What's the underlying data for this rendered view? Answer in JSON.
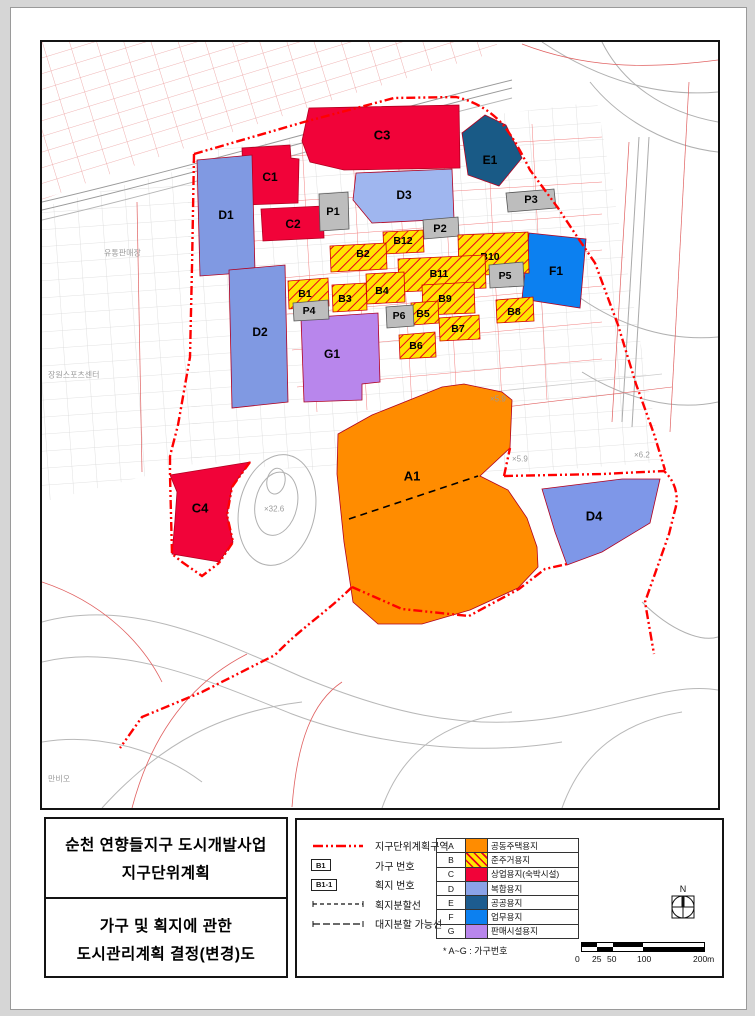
{
  "page": {
    "title_block": {
      "line1": "순천 연향들지구 도시개발사업",
      "line2": "지구단위계획",
      "line3": "가구 및 획지에 관한",
      "line4": "도시관리계획 결정(변경)도"
    },
    "legend": {
      "line_items": [
        {
          "label": "지구단위계획구역"
        },
        {
          "label": "가구 번호",
          "chip": "B1"
        },
        {
          "label": "획지 번호",
          "chip": "B1-1"
        },
        {
          "label": "획지분할선"
        },
        {
          "label": "대지분할 가능선"
        }
      ],
      "use_table": [
        {
          "code": "A",
          "use": "공동주택용지",
          "color": "#ff8c00",
          "hatch": false
        },
        {
          "code": "B",
          "use": "준주거용지",
          "color": "#ffe500",
          "hatch": true
        },
        {
          "code": "C",
          "use": "상업용지(숙박시설)",
          "color": "#f10339",
          "hatch": false
        },
        {
          "code": "D",
          "use": "복합용지",
          "color": "#8ba3e8",
          "hatch": false
        },
        {
          "code": "E",
          "use": "공공용지",
          "color": "#1d5c8f",
          "hatch": false
        },
        {
          "code": "F",
          "use": "업무용지",
          "color": "#0c80f0",
          "hatch": false
        },
        {
          "code": "G",
          "use": "판매시설용지",
          "color": "#b886ec",
          "hatch": false
        }
      ],
      "footnote": "* A~G : 가구번호"
    },
    "north_label": "N",
    "scale_bar": {
      "labels": [
        "0",
        "25",
        "50",
        "100",
        "200m"
      ]
    },
    "map": {
      "zones": [
        {
          "id": "C3",
          "label": "C3",
          "color": "#f10339",
          "points": "260,99 267,66 417,63 418,126 302,128 268,120",
          "lx": 340,
          "ly": 93,
          "fs": 13
        },
        {
          "id": "E1",
          "label": "E1",
          "color": "#195a86",
          "points": "420,91 443,73 464,83 480,116 457,144 426,133",
          "lx": 448,
          "ly": 118,
          "fs": 12
        },
        {
          "id": "C1",
          "label": "C1",
          "color": "#f10339",
          "points": "200,106 248,103 249,116 257,117 256,161 202,163",
          "lx": 228,
          "ly": 135,
          "fs": 12
        },
        {
          "id": "C2",
          "label": "C2",
          "color": "#f10339",
          "points": "219,167 281,164 282,196 221,199",
          "lx": 251,
          "ly": 182,
          "fs": 12
        },
        {
          "id": "D1",
          "label": "D1",
          "color": "#8099e2",
          "points": "155,118 210,113 213,230 158,234",
          "lx": 184,
          "ly": 173,
          "fs": 12
        },
        {
          "id": "D2",
          "label": "D2",
          "color": "#8099e2",
          "points": "187,228 243,223 246,360 190,366",
          "lx": 218,
          "ly": 290,
          "fs": 12
        },
        {
          "id": "D3",
          "label": "D3",
          "color": "#9fb6ef",
          "points": "314,131 410,127 412,177 330,181 311,158",
          "lx": 362,
          "ly": 153,
          "fs": 12
        },
        {
          "id": "P1",
          "label": "P1",
          "color": "#bdbdbd",
          "stroke": "#555",
          "points": "277,152 306,150 307,187 278,189",
          "lx": 291,
          "ly": 170,
          "fs": 11
        },
        {
          "id": "P2",
          "label": "P2",
          "color": "#bdbdbd",
          "stroke": "#555",
          "points": "381,178 416,175 417,194 382,197",
          "lx": 398,
          "ly": 187,
          "fs": 11
        },
        {
          "id": "P3",
          "label": "P3",
          "color": "#bdbdbd",
          "stroke": "#555",
          "points": "464,151 512,147 514,166 466,170",
          "lx": 489,
          "ly": 158,
          "fs": 11
        },
        {
          "id": "F1",
          "label": "F1",
          "color": "#0c80f0",
          "points": "487,191 544,197 538,266 480,257",
          "lx": 514,
          "ly": 229,
          "fs": 12
        },
        {
          "id": "G1",
          "label": "G1",
          "color": "#b886ec",
          "points": "259,276 336,271 338,340 320,342 320,358 262,360",
          "lx": 290,
          "ly": 312,
          "fs": 12
        },
        {
          "id": "B12",
          "label": "B12",
          "hatch": true,
          "points": "341,190 381,188 382,210 342,212",
          "lx": 361,
          "ly": 199,
          "fs": 10.5
        },
        {
          "id": "B2",
          "label": "B2",
          "hatch": true,
          "points": "288,204 344,201 345,227 289,230",
          "lx": 321,
          "ly": 212,
          "fs": 10.5
        },
        {
          "id": "B10",
          "label": "B10",
          "hatch": true,
          "points": "416,193 486,190 487,231 417,234",
          "lx": 448,
          "ly": 215,
          "fs": 10.5
        },
        {
          "id": "B11",
          "label": "B11",
          "hatch": true,
          "points": "356,217 443,213 444,246 357,250",
          "lx": 397,
          "ly": 232,
          "fs": 10.5
        },
        {
          "id": "B1",
          "label": "B1",
          "hatch": true,
          "points": "246,239 286,236 287,264 247,267",
          "lx": 263,
          "ly": 252,
          "fs": 10.5
        },
        {
          "id": "B3",
          "label": "B3",
          "hatch": true,
          "points": "290,243 324,241 325,268 291,270",
          "lx": 303,
          "ly": 257,
          "fs": 10.5
        },
        {
          "id": "B4",
          "label": "B4",
          "hatch": true,
          "points": "324,232 362,230 363,260 325,262",
          "lx": 340,
          "ly": 249,
          "fs": 10.5
        },
        {
          "id": "B9",
          "label": "B9",
          "hatch": true,
          "points": "380,243 432,240 433,271 381,273",
          "lx": 403,
          "ly": 257,
          "fs": 10.5
        },
        {
          "id": "B5",
          "label": "B5",
          "hatch": true,
          "points": "369,261 396,259 397,281 370,283",
          "lx": 381,
          "ly": 272,
          "fs": 10.5
        },
        {
          "id": "B7",
          "label": "B7",
          "hatch": true,
          "points": "397,276 437,273 438,297 398,299",
          "lx": 416,
          "ly": 287,
          "fs": 10.5
        },
        {
          "id": "B8",
          "label": "B8",
          "hatch": true,
          "points": "454,258 491,255 492,279 455,281",
          "lx": 472,
          "ly": 270,
          "fs": 10.5
        },
        {
          "id": "B6",
          "label": "B6",
          "hatch": true,
          "points": "357,293 393,290 394,315 358,317",
          "lx": 374,
          "ly": 304,
          "fs": 10.5
        },
        {
          "id": "P4",
          "label": "P4",
          "color": "#bdbdbd",
          "stroke": "#555",
          "points": "251,261 286,258 287,277 252,279",
          "lx": 267,
          "ly": 269,
          "fs": 10.5
        },
        {
          "id": "P6",
          "label": "P6",
          "color": "#bdbdbd",
          "stroke": "#555",
          "points": "344,265 371,263 372,284 345,286",
          "lx": 357,
          "ly": 274,
          "fs": 10.5
        },
        {
          "id": "P5",
          "label": "P5",
          "color": "#bdbdbd",
          "stroke": "#555",
          "points": "447,223 481,220 482,244 448,246",
          "lx": 463,
          "ly": 234,
          "fs": 10.5
        },
        {
          "id": "A1",
          "label": "A1",
          "color": "#ff8c00",
          "points": "296,392 330,373 400,345 422,342 460,350 470,358 468,406 438,434 466,448 485,476 495,505 496,525 476,546 428,568 380,582 336,582 311,560 302,500 295,432",
          "lx": 370,
          "ly": 434,
          "fs": 13
        },
        {
          "id": "C4",
          "label": "C4",
          "color": "#f10339",
          "points": "128,433 208,420 190,445 185,473 191,500 177,520 130,512 133,478 135,450",
          "lx": 158,
          "ly": 466,
          "fs": 13
        },
        {
          "id": "D4",
          "label": "D4",
          "color": "#7e97e8",
          "points": "500,447 580,437 618,437 608,481 560,510 525,523 513,490",
          "lx": 552,
          "ly": 474,
          "fs": 13
        }
      ],
      "background_labels": [
        {
          "text": "유통판매장",
          "x": 62,
          "y": 211,
          "size": 8
        },
        {
          "text": "장원스포츠센터",
          "x": 6,
          "y": 333,
          "size": 8
        },
        {
          "text": "만비오",
          "x": 6,
          "y": 737,
          "size": 8
        },
        {
          "text": "×5.9",
          "x": 448,
          "y": 357,
          "size": 8
        },
        {
          "text": "×5.9",
          "x": 470,
          "y": 417,
          "size": 8
        },
        {
          "text": "×6.2",
          "x": 592,
          "y": 413,
          "size": 8
        },
        {
          "text": "×32.6",
          "x": 222,
          "y": 467,
          "size": 8
        }
      ]
    }
  }
}
